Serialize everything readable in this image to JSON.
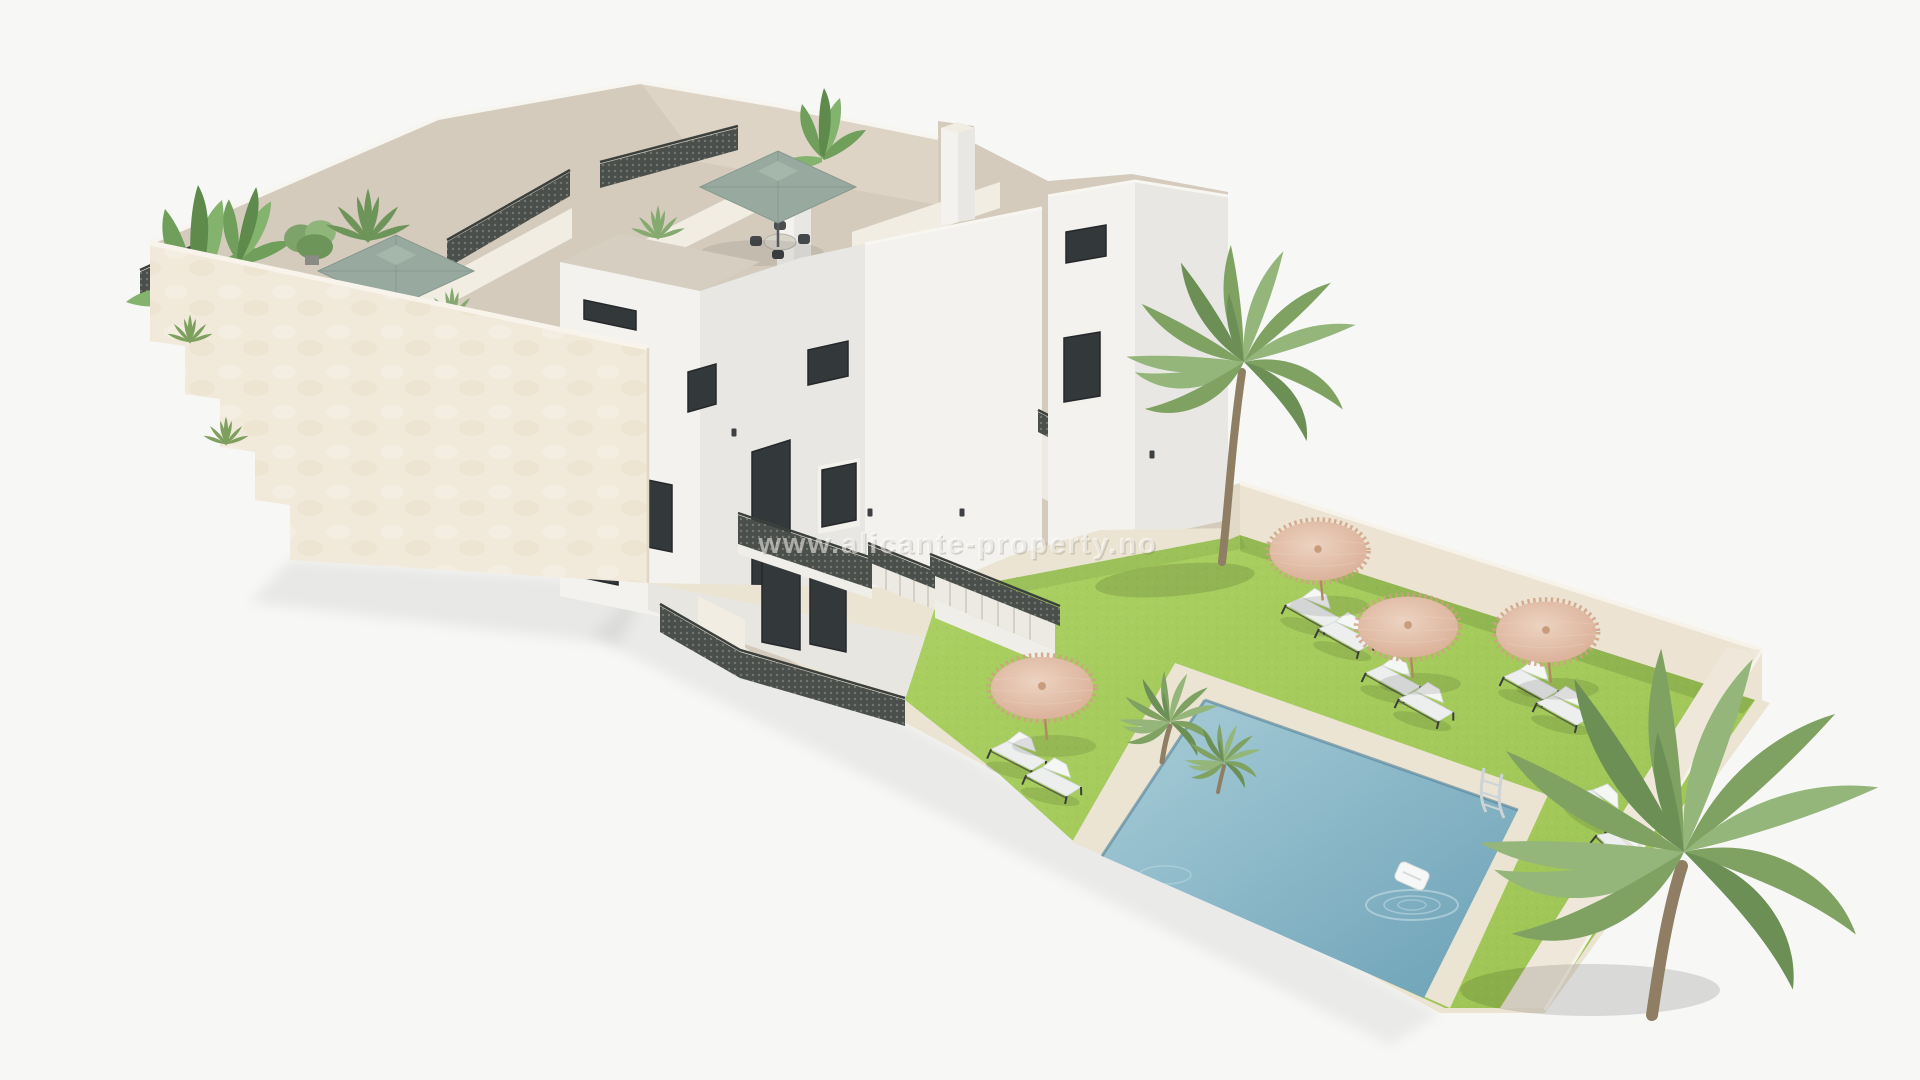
{
  "watermark": {
    "text": "www.alicante-property.no"
  },
  "colors": {
    "background": "#f7f7f5",
    "wall_cream": "#f1e9da",
    "wall_white": "#f3f2ee",
    "wall_shaded": "#e8e7e3",
    "roof": "#d4cbbd",
    "grass": "#9cc453",
    "grass_light": "#abd063",
    "pool_light": "#a9cdd8",
    "pool_deep": "#6ba1b6",
    "coping": "#ece4d3",
    "straw_light": "#ecd3c1",
    "straw_deep": "#d8aa91",
    "sage": "#98aaa0",
    "palm": "#7fa263",
    "trunk": "#8f7e63",
    "glass": "#33383b",
    "lattice": "#4b4f4b"
  }
}
